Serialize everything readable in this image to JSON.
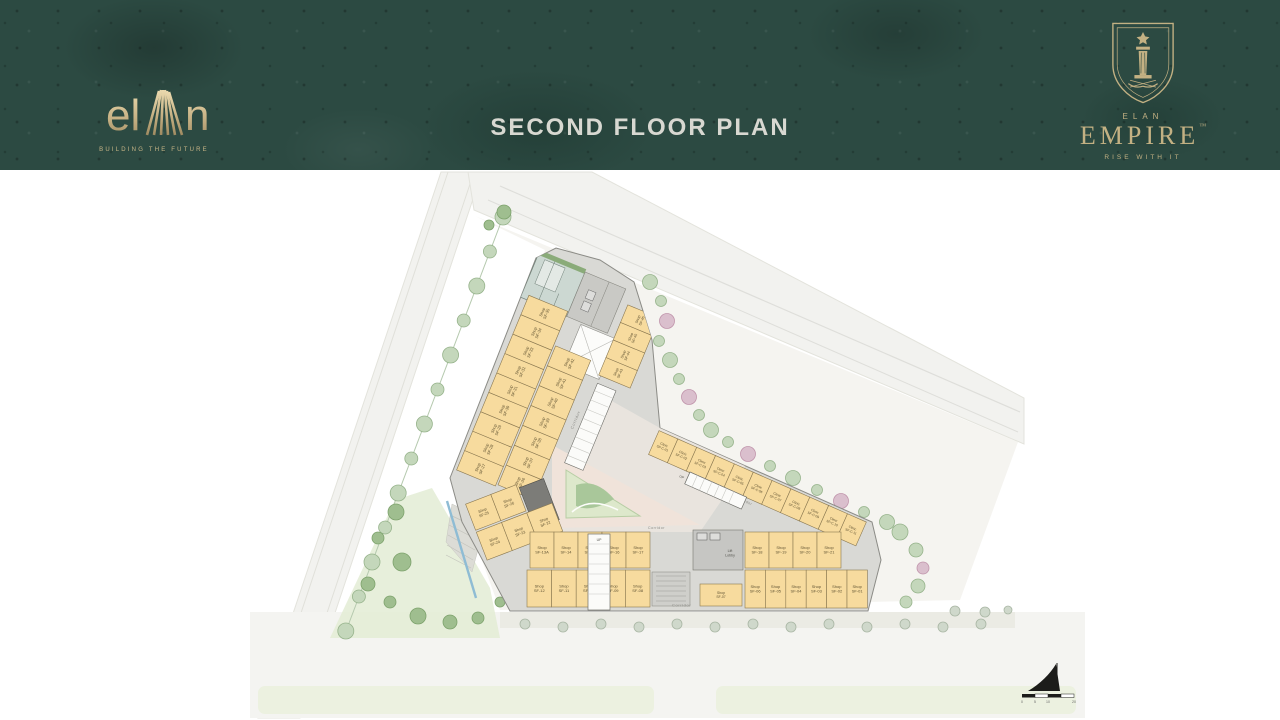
{
  "header": {
    "title": "SECOND FLOOR PLAN",
    "brand_left": {
      "wordmark_el": "el",
      "wordmark_n": "n",
      "tagline": "BUILDING THE FUTURE"
    },
    "brand_right": {
      "eyebrow": "ELAN",
      "wordmark": "EMPIRE",
      "trademark": "™",
      "tagline": "RISE WITH IT"
    },
    "colors": {
      "background": "#2c4a42",
      "gold": "#c7b285",
      "title_silver": "#d8d8d1"
    }
  },
  "plan": {
    "unit_prefix_shop": "Shop",
    "unit_prefix_clinic": "Clinic",
    "labels": {
      "corridor": "Corridor",
      "lift_lobby_line1": "Lift",
      "lift_lobby_line2": "Lobby",
      "up": "UP"
    },
    "units": {
      "bottom_top_left": [
        "SF-13A",
        "SF-14",
        "SF-15",
        "SF-16",
        "SF-17"
      ],
      "bottom_top_right": [
        "SF-18",
        "SF-19",
        "SF-20",
        "SF-21"
      ],
      "bottom_bottom_left": [
        "SF-12",
        "SF-11",
        "SF-10",
        "SF-09",
        "SF-08"
      ],
      "bottom_bottom_right": [
        "SF-06",
        "SF-05",
        "SF-04",
        "SF-03",
        "SF-02",
        "SF-01"
      ],
      "near_core": [
        "SF-07"
      ],
      "vertex_row1": [
        "SF-25",
        "SF-26"
      ],
      "vertex_row2": [
        "SF-24",
        "SF-23",
        "SF-22"
      ],
      "left_outer": [
        "SF-27",
        "SF-28",
        "SF-29",
        "SF-30",
        "SF-31",
        "SF-32",
        "SF-33",
        "SF-34",
        "SF-35"
      ],
      "left_inner": [
        "SF-36",
        "SF-37",
        "SF-38",
        "SF-39",
        "SF-40",
        "SF-41",
        "SF-42"
      ],
      "east_strip": [
        "SF-43",
        "SF-44",
        "SF-45",
        "SF-46"
      ],
      "clinic_row": [
        "SF-C-01",
        "SF-C-02",
        "SF-C-03",
        "SF-C-04",
        "SF-C-05",
        "SF-C-06",
        "SF-C-07",
        "SF-C-08",
        "SF-C-09",
        "SF-C-10",
        "SF-C-11"
      ]
    },
    "scale_ticks": [
      "0",
      "5",
      "10",
      "20"
    ],
    "colors": {
      "shop_fill": "#f7db9e",
      "shop_border": "#8a7850",
      "shop_text": "#5f5232",
      "corridor_gray": "#d9d9d5",
      "services_teal": "#ccd8d2",
      "plaza_pink": "#f0e3da",
      "garden_green": "#dde8cb",
      "road": "#f2f2ef",
      "tree_green": "#c4d7bb"
    }
  }
}
